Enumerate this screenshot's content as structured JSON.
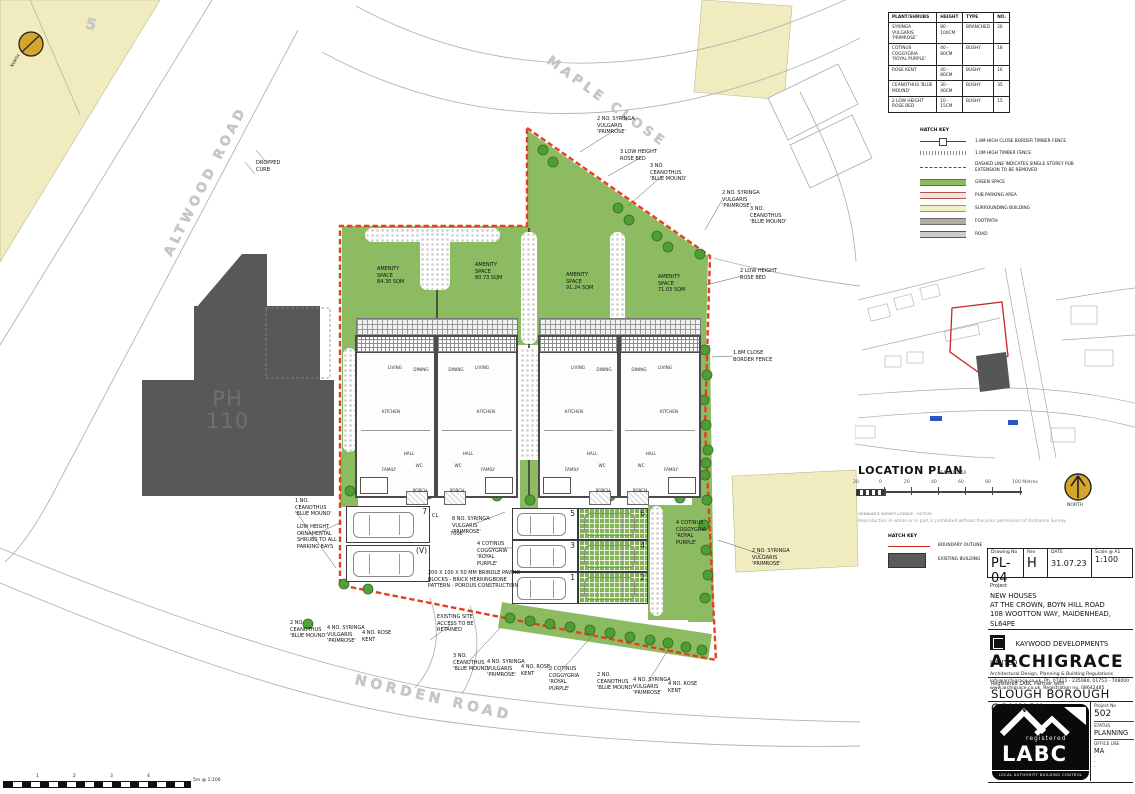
{
  "site_plan": {
    "plot_number": "5",
    "pub_label": "PH\n110",
    "north_label": "NORTH",
    "road_labels": [
      {
        "text": "ALTWOOD ROAD",
        "x": 168,
        "y": 248,
        "rot": -63,
        "size": 13
      },
      {
        "text": "MAPLE CLOSE",
        "x": 548,
        "y": 52,
        "rot": 36,
        "size": 13
      },
      {
        "text": "NORDEN ROAD",
        "x": 355,
        "y": 672,
        "rot": 13,
        "size": 14
      }
    ],
    "annotations": [
      {
        "x": 377,
        "y": 266,
        "t": "AMENITY\nSPACE\n84.30 SQM"
      },
      {
        "x": 475,
        "y": 262,
        "t": "AMENITY\nSPACE\n80.73 SQM"
      },
      {
        "x": 566,
        "y": 272,
        "t": "AMENITY\nSPACE\n91.24 SQM"
      },
      {
        "x": 658,
        "y": 274,
        "t": "AMENITY\nSPACE\n71.03 SQM"
      },
      {
        "x": 597,
        "y": 116,
        "t": "2 NO. SYRINGA\nVULGARIS\n'PRIMROSE'"
      },
      {
        "x": 620,
        "y": 149,
        "t": "3 LOW HEIGHT\nROSE BED"
      },
      {
        "x": 650,
        "y": 163,
        "t": "3 NO.\nCEANOTHUS\n'BLUE MOUND'"
      },
      {
        "x": 722,
        "y": 190,
        "t": "2 NO. SYRINGA\nVULGARIS\n'PRIMROSE'"
      },
      {
        "x": 750,
        "y": 206,
        "t": "3 NO.\nCEANOTHUS\n'BLUE MOUND'"
      },
      {
        "x": 740,
        "y": 268,
        "t": "2 LOW HEIGHT\nROSE BED"
      },
      {
        "x": 733,
        "y": 350,
        "t": "1.8M CLOSE\nBORDER FENCE"
      },
      {
        "x": 752,
        "y": 548,
        "t": "2 NO. SYRINGA\nVULGARIS\n'PRIMROSE'"
      },
      {
        "x": 295,
        "y": 498,
        "t": "1 NO.\nCEANOTHUS\n'BLUE MOUND'"
      },
      {
        "x": 297,
        "y": 524,
        "t": "LOW HEIGHT\nORNAMENTAL\nSHRUBS TO ALL\nPARKING BAYS"
      },
      {
        "x": 452,
        "y": 516,
        "t": "8 NO. SYRINGA\nVULGARIS\n'PRIMROSE'"
      },
      {
        "x": 477,
        "y": 541,
        "t": "4 COTINUS\nCOGGYGRIA\n'ROYAL\nPURPLE'"
      },
      {
        "x": 428,
        "y": 570,
        "t": "200 X 100 X 50 MM BRINDLE PAVING\nBLOCKS - BRICK HERRINGBONE\nPATTERN - POROUS CONSTRUCTION"
      },
      {
        "x": 676,
        "y": 520,
        "t": "4 COTINUS\nCOGGYGRIA\n'ROYAL\nPURPLE'"
      },
      {
        "x": 290,
        "y": 620,
        "t": "2 NO.\nCEANOTHUS\n'BLUE MOUND'"
      },
      {
        "x": 327,
        "y": 625,
        "t": "4 NO. SYRINGA\nVULGARIS\n'PRIMROSE'"
      },
      {
        "x": 362,
        "y": 630,
        "t": "4 NO. ROSE\nKENT"
      },
      {
        "x": 437,
        "y": 614,
        "t": "EXISTING SITE\nACCESS TO BE\nRETAINED"
      },
      {
        "x": 453,
        "y": 653,
        "t": "3 NO.\nCEANOTHUS\n'BLUE MOUND'"
      },
      {
        "x": 487,
        "y": 659,
        "t": "4 NO. SYRINGA\nVULGARIS\n'PRIMROSE'"
      },
      {
        "x": 521,
        "y": 664,
        "t": "4 NO. ROSE\nKENT"
      },
      {
        "x": 549,
        "y": 666,
        "t": "2 COTINUS\nCOGGYGRIA\n'ROYAL\nPURPLE'"
      },
      {
        "x": 597,
        "y": 672,
        "t": "2 NO.\nCEANOTHUS\n'BLUE MOUND'"
      },
      {
        "x": 633,
        "y": 677,
        "t": "4 NO. SYRINGA\nVULGARIS\n'PRIMROSE'"
      },
      {
        "x": 668,
        "y": 681,
        "t": "4 NO. ROSE\nKENT"
      },
      {
        "x": 256,
        "y": 160,
        "t": "DROPPED\nCURB"
      },
      {
        "x": 432,
        "y": 513,
        "t": "CL"
      },
      {
        "x": 450,
        "y": 531,
        "t": "7000"
      }
    ],
    "houses": {
      "units": [
        {
          "x": 355,
          "m": false,
          "pwr": true
        },
        {
          "x": 436,
          "m": true,
          "pwr": false
        },
        {
          "x": 538,
          "m": false,
          "pwr": true
        },
        {
          "x": 619,
          "m": true,
          "pwr": false
        }
      ],
      "rooms": [
        {
          "t": "LIVING",
          "x": 38,
          "y": 28
        },
        {
          "t": "DINING",
          "x": 64,
          "y": 30
        },
        {
          "t": "KITCHEN",
          "x": 34,
          "y": 72
        },
        {
          "t": "HALL",
          "x": 52,
          "y": 114
        },
        {
          "t": "WC",
          "x": 62,
          "y": 126
        },
        {
          "t": "FAMILY",
          "x": 32,
          "y": 130
        },
        {
          "t": "PORCH",
          "x": 63,
          "y": 151
        }
      ]
    },
    "parking": {
      "bays": [
        {
          "n": "7",
          "x": 346,
          "y": 506,
          "w": 84,
          "h": 37,
          "g": false
        },
        {
          "n": "(V)",
          "x": 346,
          "y": 545,
          "w": 84,
          "h": 37,
          "g": false
        },
        {
          "n": "5",
          "x": 512,
          "y": 508,
          "w": 66,
          "h": 32,
          "g": false
        },
        {
          "n": "6",
          "x": 578,
          "y": 508,
          "w": 70,
          "h": 32,
          "g": true
        },
        {
          "n": "3",
          "x": 512,
          "y": 540,
          "w": 66,
          "h": 32,
          "g": false
        },
        {
          "n": "4",
          "x": 578,
          "y": 540,
          "w": 70,
          "h": 32,
          "g": true
        },
        {
          "n": "1",
          "x": 512,
          "y": 572,
          "w": 66,
          "h": 32,
          "g": false
        },
        {
          "n": "2",
          "x": 578,
          "y": 572,
          "w": 70,
          "h": 32,
          "g": true
        }
      ]
    },
    "trees": [
      [
        543,
        150
      ],
      [
        553,
        162
      ],
      [
        618,
        208
      ],
      [
        629,
        220
      ],
      [
        657,
        236
      ],
      [
        668,
        247
      ],
      [
        700,
        254
      ],
      [
        705,
        350
      ],
      [
        707,
        375
      ],
      [
        704,
        400
      ],
      [
        706,
        425
      ],
      [
        708,
        450
      ],
      [
        705,
        475
      ],
      [
        707,
        500
      ],
      [
        704,
        525
      ],
      [
        706,
        550
      ],
      [
        708,
        575
      ],
      [
        705,
        598
      ],
      [
        510,
        618
      ],
      [
        530,
        621
      ],
      [
        550,
        624
      ],
      [
        570,
        627
      ],
      [
        590,
        630
      ],
      [
        610,
        633
      ],
      [
        630,
        637
      ],
      [
        650,
        640
      ],
      [
        668,
        643
      ],
      [
        686,
        647
      ],
      [
        702,
        650
      ],
      [
        350,
        491
      ],
      [
        344,
        584
      ],
      [
        368,
        589
      ],
      [
        308,
        624
      ],
      [
        530,
        500
      ],
      [
        428,
        494
      ],
      [
        497,
        496
      ],
      [
        610,
        496
      ],
      [
        680,
        498
      ],
      [
        706,
        463
      ]
    ],
    "scalebar": {
      "labels": [
        [
          36,
          "1"
        ],
        [
          73,
          "2"
        ],
        [
          110,
          "3"
        ],
        [
          147,
          "4"
        ]
      ],
      "caption": "5m @ 1:100"
    }
  },
  "plant_table": {
    "headers": [
      "PLANT/SHRUBS",
      "HEIGHT",
      "TYPE",
      "NO."
    ],
    "rows": [
      [
        "SYRINGA VULGARIS 'PRIMROSE'",
        "80 - 100CM",
        "BRANCHED",
        "26"
      ],
      [
        "COTINUS COGGYGRIA 'ROYAL PURPLE'",
        "40 - 80CM",
        "BUSHY",
        "18"
      ],
      [
        "ROSE KENT",
        "40 - 80CM",
        "BUSHY",
        "16"
      ],
      [
        "CEANOTHUS 'BLUE MOUND'",
        "30 - 40CM",
        "BUSHY",
        "35"
      ],
      [
        "2 LOW HEIGHT ROSE BED",
        "10 - 15CM",
        "BUSHY",
        "15"
      ]
    ]
  },
  "hatch_key": {
    "title": "HATCH KEY",
    "items": [
      {
        "label": "1.8M HIGH CLOSE BORDER TIMBER FENCE",
        "type": "fence-close"
      },
      {
        "label": "1.0M HIGH TIMBER FENCE",
        "type": "fence-low"
      },
      {
        "label": "DASHED LINE INDICATES SINGLE STOREY PUB EXTENSION TO BE REMOVED",
        "type": "dashed"
      },
      {
        "label": "GREEN SPACE",
        "type": "swatch",
        "color": "#8CBB62",
        "line": "#4e7d35"
      },
      {
        "label": "PUB PARKING AREA",
        "type": "swatch",
        "color": "#F2E3DE",
        "line": "#b2564a"
      },
      {
        "label": "SURROUNDING BUILDING",
        "type": "swatch",
        "color": "#F2EFC9",
        "line": "#9a9a55"
      },
      {
        "label": "FOOTPATH",
        "type": "swatch",
        "color": "#AFAEA2",
        "line": "#6e6e64"
      },
      {
        "label": "ROAD",
        "type": "swatch",
        "color": "#CCCCCC",
        "line": "#555555"
      }
    ]
  },
  "location_plan": {
    "title": "LOCATION PLAN",
    "scale_note": "SCALE 1:1250",
    "scale_ticks": [
      [
        853,
        "20"
      ],
      [
        879,
        "0"
      ],
      [
        904,
        "20"
      ],
      [
        931,
        "40"
      ],
      [
        958,
        "60"
      ],
      [
        985,
        "80"
      ],
      [
        1012,
        "100 Metres"
      ]
    ],
    "north_label": "NORTH",
    "ordnance_line1": "ORDNANCE SURVEY LICENCE - 027570",
    "ordnance_line2": "Reproduction in whole or in part is prohibited without the prior permission of Ordnance Survey."
  },
  "legend2": {
    "title": "HATCH KEY",
    "boundary": "BOUNDARY OUTLINE",
    "existing": "EXISTING BUILDING"
  },
  "title_block": {
    "drawing_no_label": "Drawing No",
    "drawing_no": "PL-04",
    "rev_label": "Rev",
    "rev": "H",
    "date_label": "DATE",
    "date": "31.07.23",
    "scale_label": "Scale @ A1",
    "scale": "1:100",
    "project_label": "Project",
    "project_line1": "NEW HOUSES",
    "project_line2": "AT THE CROWN, BOYN HILL ROAD",
    "project_line3": "108 WOOTTON WAY, MAIDENHEAD, SL64PE",
    "client_label": "Client",
    "client": "KAYWOOD DEVELOPMENTS LIMITED",
    "firm": "ARCHIGRACE",
    "firm_desc": "Architectural Design, Planning & Building Regulations",
    "firm_contact": "info@archigrace.co.uk, Ph. 07411 - 235080, 01753 - 708000",
    "firm_web": "www.archigrace.co.uk,      Registration no. 08642485",
    "labc_partner": "Registered LABC Partner with",
    "council": "SLOUGH BOROUGH COUNCIL",
    "labc_registered": "registered",
    "labc_name": "LABC",
    "labc_tagline": "LOCAL AUTHORITY BUILDING CONTROL",
    "project_no_label": "Project No",
    "project_no": "502",
    "status_label": "STATUS",
    "status": "PLANNING",
    "office_label": "OFFICE USE",
    "office": "MA",
    "dashes": "-"
  }
}
